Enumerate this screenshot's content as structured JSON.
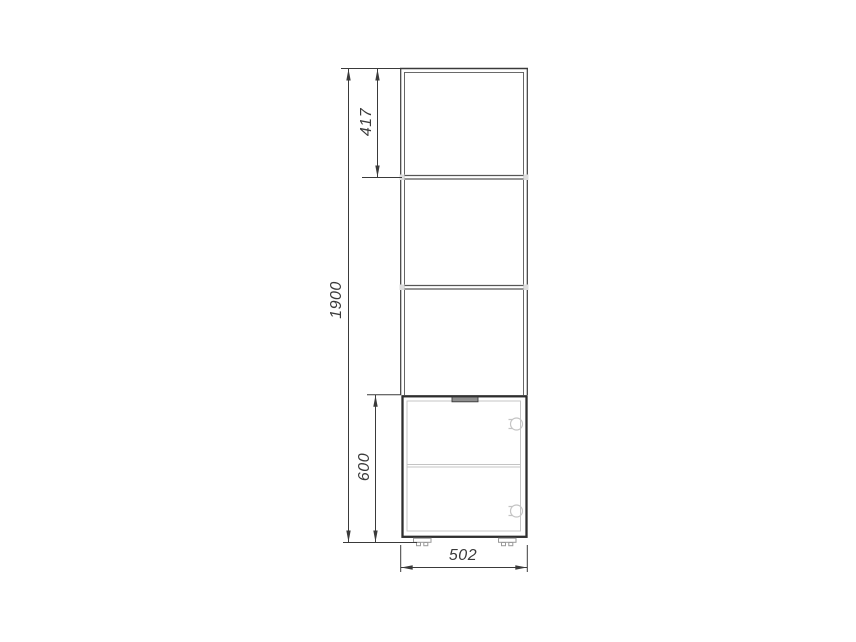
{
  "drawing": {
    "type": "furniture-dimension-drawing",
    "dimensions": {
      "overall_height": "1900",
      "upper_shelf_spacing": "417",
      "base_cabinet_height": "600",
      "overall_width": "502"
    },
    "colors": {
      "line_dark": "#3a3a3a",
      "line_medium": "#565656",
      "line_light": "#c4c4c4",
      "handle_fill": "#8f8f8f",
      "background": "#ffffff"
    }
  }
}
